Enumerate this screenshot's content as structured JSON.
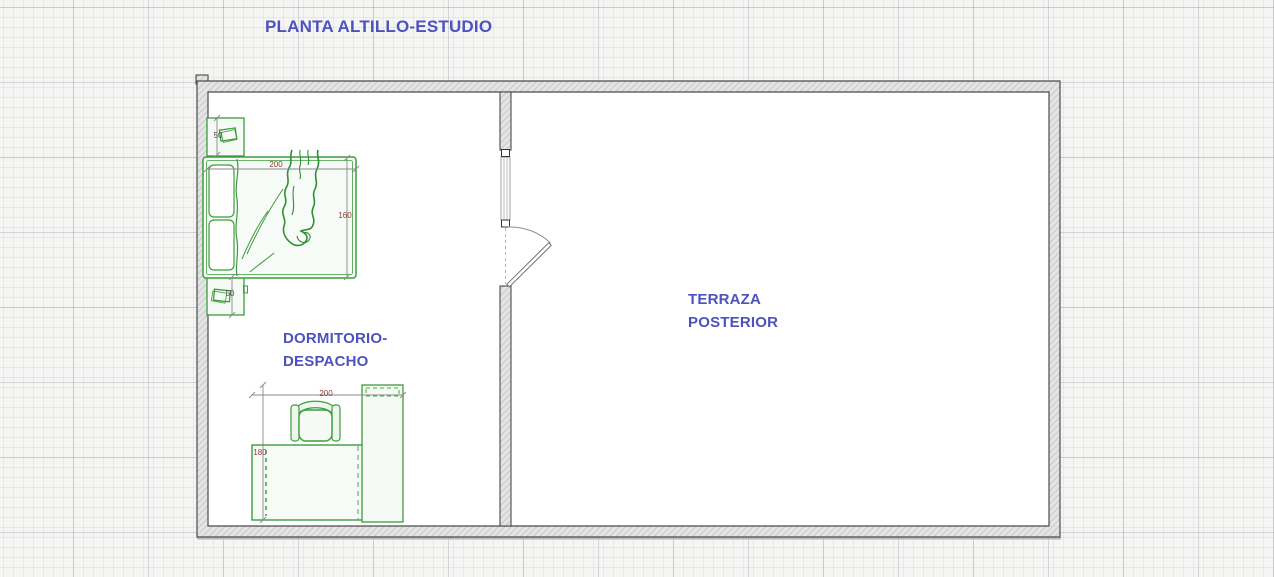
{
  "title": "PLANTA ALTILLO-ESTUDIO",
  "rooms": {
    "bedroom_office": {
      "line1": "DORMITORIO-",
      "line2": "DESPACHO"
    },
    "rear_terrace": {
      "line1": "TERRAZA",
      "line2": "POSTERIOR"
    }
  },
  "dimensions": {
    "bed_width": "200",
    "bed_length": "160",
    "nightstand_top": "50",
    "nightstand_bottom": "50",
    "desk_width": "200",
    "desk_depth": "180"
  },
  "symbols": [
    "double-bed-icon",
    "nightstand-icon",
    "nightstand-icon",
    "desk-icon",
    "office-chair-icon",
    "shelf-cabinet-icon",
    "door-swing-icon",
    "window-icon"
  ],
  "colors": {
    "label_blue": "#4d52bd",
    "furniture_green": "#3d9c3d",
    "dimension_red": "#8e3b32",
    "dimension_gray": "#4f4f4f",
    "wall_outline": "#4b4b4b",
    "wall_hatch": "#c2c2c2",
    "grid_background": "#f5f5f3"
  }
}
